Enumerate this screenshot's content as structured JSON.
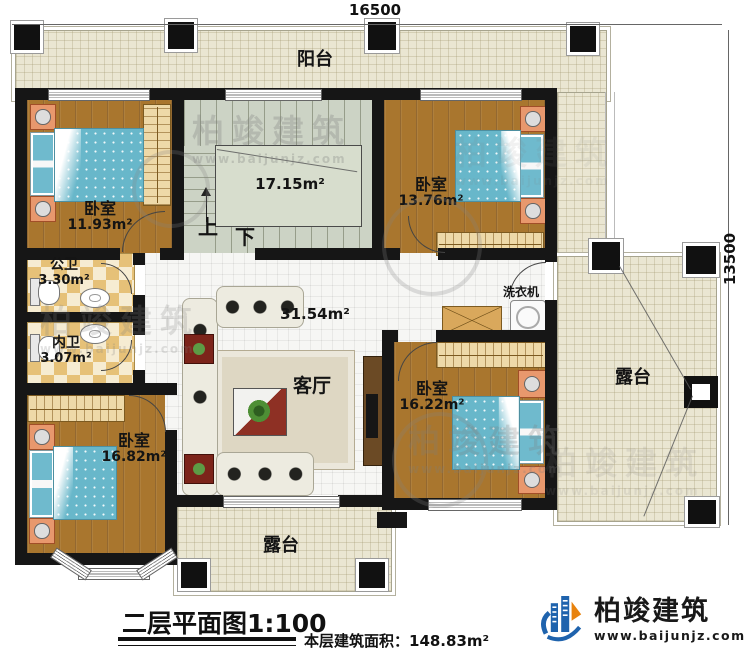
{
  "plan": {
    "dim_top": "16500",
    "dim_right": "13500",
    "balcony": "阳台",
    "bedroom_tl": {
      "name": "卧室",
      "area": "11.93m²"
    },
    "stairs": {
      "area": "17.15m²",
      "up": "上",
      "down": "下"
    },
    "bedroom_tr": {
      "name": "卧室",
      "area": "13.76m²"
    },
    "public_wc": {
      "name": "公卫",
      "area": "3.30m²"
    },
    "inner_wc": {
      "name": "内卫",
      "area": "3.07m²"
    },
    "hall_area": "31.54m²",
    "living": "客厅",
    "washer": "洗衣机",
    "bedroom_right": {
      "name": "卧室",
      "area": "16.22m²"
    },
    "terrace_right": "露台",
    "bedroom_bl": {
      "name": "卧室",
      "area": "16.82m²"
    },
    "terrace_bottom": "露台"
  },
  "footer": {
    "title": "二层平面图1:100",
    "floor_area": "本层建筑面积：148.83m²"
  },
  "brand": {
    "name": "柏竣建筑",
    "site": "www.baijunjz.com"
  },
  "watermark": {
    "name": "柏竣建筑",
    "site": "www.baijunjz.com"
  },
  "colors": {
    "wood": "#a9762e",
    "terrace": "#eae6d2",
    "stairs": "#ccd3c5",
    "wall": "#161616",
    "bed": "#68b7ca",
    "brand_blue": "#1f63ad",
    "brand_orange": "#e8820c"
  }
}
